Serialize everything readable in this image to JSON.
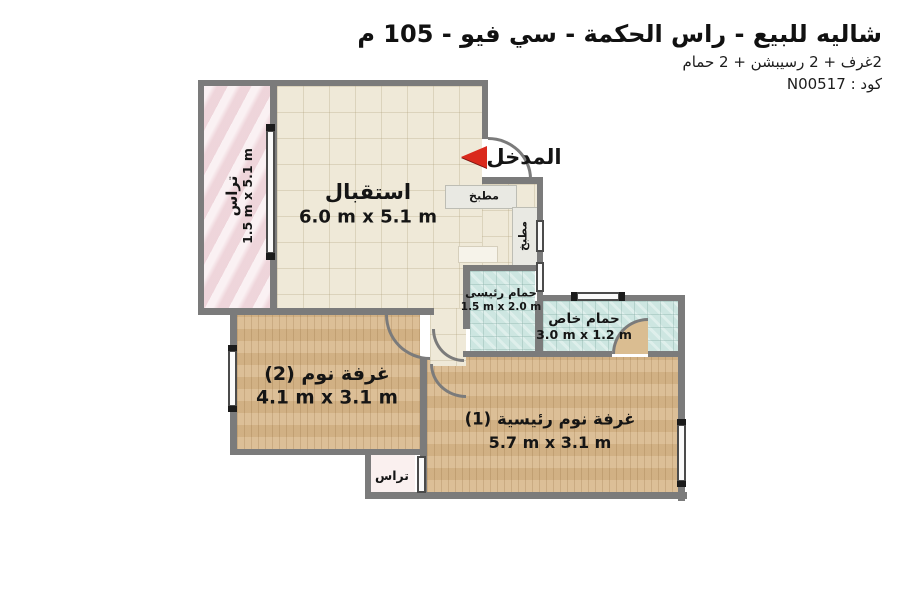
{
  "header": {
    "title": "شاليه للبيع - راس الحكمة - سي فيو - 105 م",
    "subtitle": "2غرف + 2 رسيبشن + 2 حمام",
    "code_label": "كود : N00517"
  },
  "entrance": {
    "label": "المدخل"
  },
  "rooms": {
    "reception": {
      "name": "استقبال",
      "dims": "6.0 m x 5.1 m"
    },
    "terrace_left": {
      "name": "تراس",
      "dims": "1.5 m x 5.1 m"
    },
    "kitchen_a": {
      "name": "مطبخ"
    },
    "kitchen_b": {
      "name": "مطبخ"
    },
    "bathroom_main": {
      "name": "حمام رئيسى",
      "dims": "1.5 m x 2.0 m"
    },
    "bathroom_private": {
      "name": "حمام خاص",
      "dims": "3.0 m x 1.2 m"
    },
    "bedroom_2": {
      "name": "غرفة نوم (2)",
      "dims": "4.1 m x 3.1 m"
    },
    "bedroom_main": {
      "name": "غرفة نوم رئيسية (1)",
      "dims": "5.7 m x 3.1 m"
    },
    "terrace_small": {
      "name": "تراس"
    }
  },
  "colors": {
    "wall": "#7b7b7b",
    "reception_floor": "#efe9d8",
    "bathroom_floor": "#cde6e1",
    "bedroom_floor": "#d8b88b",
    "terrace_floor": "#f4e0e4",
    "entrance_arrow": "#da291c",
    "background": "#ffffff",
    "text": "#151515"
  }
}
